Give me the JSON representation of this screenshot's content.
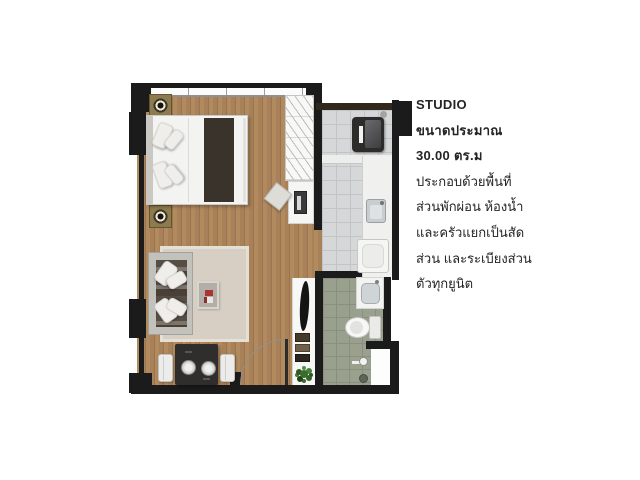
{
  "info_panel": {
    "title": "STUDIO",
    "size_label": "ขนาดประมาณ",
    "size_value": "30.00 ตร.ม",
    "description_lines": [
      "ประกอบด้วยพื้นที่",
      "ส่วนพักผ่อน ห้องน้ำ",
      "และครัวแยกเป็นสัด",
      "ส่วน และระเบียงส่วน",
      "ตัวทุกยูนิต"
    ]
  },
  "floorplan": {
    "colors": {
      "wall": "#1b1b1b",
      "wood_floor": "#a9825a",
      "kitchen_tile": "#d5d7d8",
      "bathroom_tile": "#99a08d",
      "rug": "#d7cfc3",
      "balcony_floor": "#f7f7f6",
      "plant": "#3c6b2e",
      "bed_runner": "#3a332b"
    }
  }
}
